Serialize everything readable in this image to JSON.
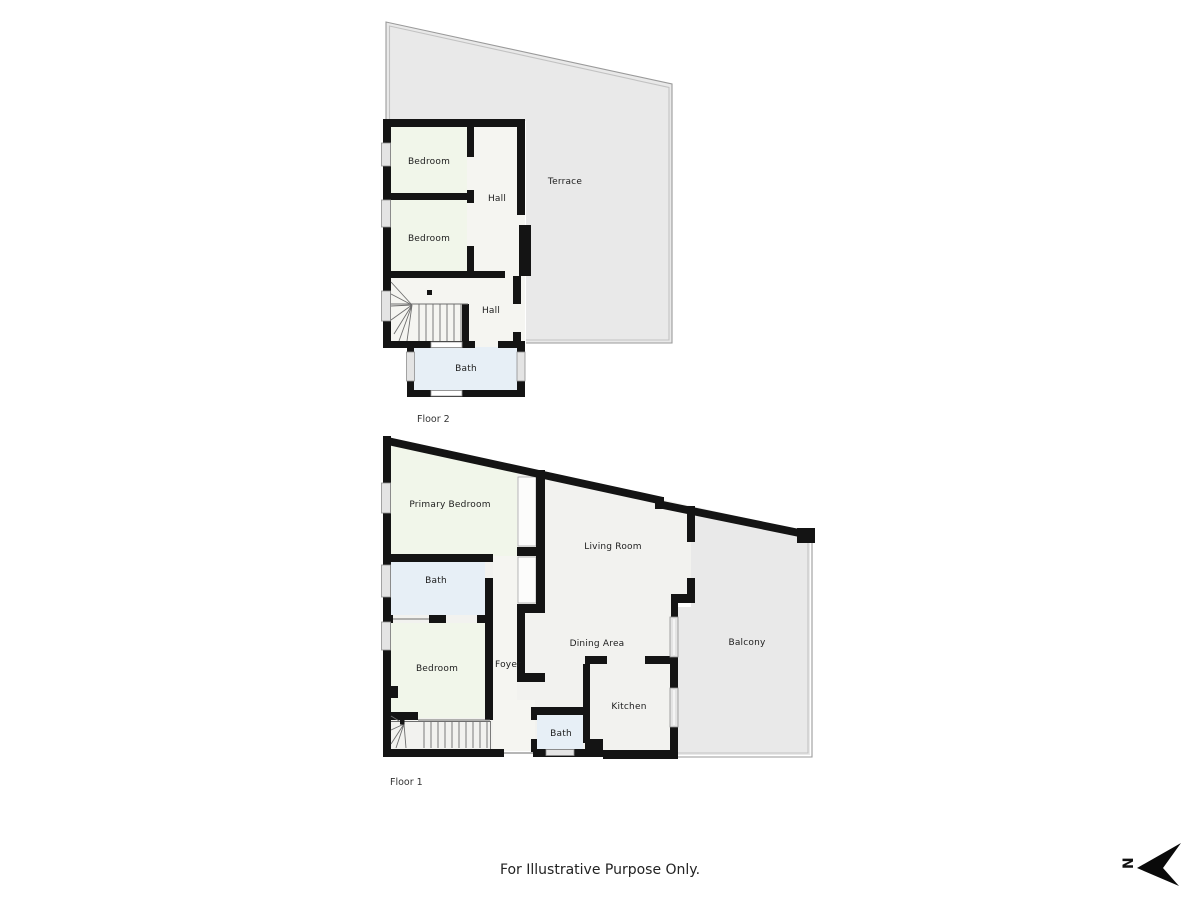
{
  "colors": {
    "wall": "#141414",
    "bedroom": "#f1f6ea",
    "bath": "#e7eff6",
    "hall": "#f5f5f1",
    "living": "#f2f2ef",
    "terrace": "#e9e9e9",
    "outline": "#9a9a9a"
  },
  "floor2": {
    "caption": "Floor 2",
    "rooms": {
      "bedroom_top": "Bedroom",
      "bedroom_bottom": "Bedroom",
      "hall_upper": "Hall",
      "hall_lower": "Hall",
      "bath": "Bath",
      "terrace": "Terrace"
    }
  },
  "floor1": {
    "caption": "Floor 1",
    "rooms": {
      "primary_bedroom": "Primary Bedroom",
      "bath_top": "Bath",
      "bedroom": "Bedroom",
      "foyer": "Foyer",
      "living_room": "Living Room",
      "dining_area": "Dining Area",
      "kitchen": "Kitchen",
      "bath_bottom": "Bath",
      "balcony": "Balcony"
    }
  },
  "footer": {
    "disclaimer": "For Illustrative Purpose Only."
  },
  "compass": {
    "letter": "N"
  }
}
